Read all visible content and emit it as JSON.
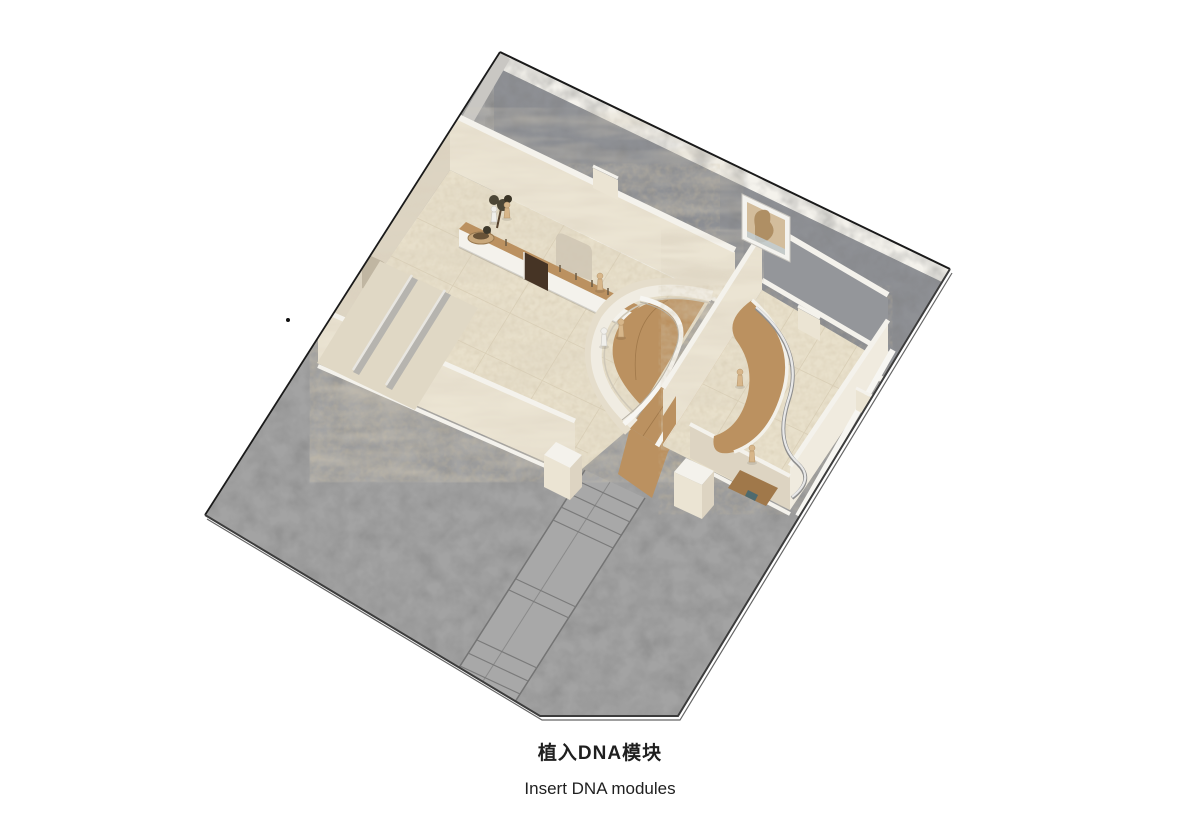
{
  "caption": {
    "title_zh": "植入DNA模块",
    "title_en": "Insert DNA modules"
  },
  "colors": {
    "background": "#ffffff",
    "outline": "#1a1a1a",
    "platform": "#a3a3a3",
    "platform_edge": "#6f6f6f",
    "terrace_gray": "#c9c7c3",
    "wall_dark": "#8f9195",
    "wall_cream": "#ebe4d3",
    "wall_cream_shade": "#ddd4c2",
    "wall_cap": "#f4f2ec",
    "floor_beige": "#e8e0cb",
    "floor_line": "#d6cbb2",
    "wood": "#bb9160",
    "wood_dark": "#a0784a",
    "rail_white": "#f7f6f2",
    "figure_beige": "#d7b68a",
    "figure_white": "#f0efeb",
    "board_brown": "#463425",
    "foliage": "#4c4636",
    "planter": "#c9a87b",
    "stair_gray": "#a8a8a8",
    "stair_line": "#747474",
    "art_frame": "#f4f3ef",
    "art_image": "#d3bd9c",
    "teal_accent": "#4d6a6e",
    "caption_text": "#1f1f1f"
  },
  "scene": {
    "description": "Axonometric cutaway rendering of a two-room retail interior set on a concrete plinth",
    "elements": [
      "concrete-plinth",
      "entry-staircase",
      "left-gallery-room",
      "restroom-stalls",
      "display-counter",
      "potted-tree",
      "arched-opening",
      "timber-half-round-deck",
      "timber-corridor",
      "right-gallery-room",
      "curved-timber-platform",
      "spiral-railing",
      "wall-artwork",
      "human-figures"
    ]
  }
}
